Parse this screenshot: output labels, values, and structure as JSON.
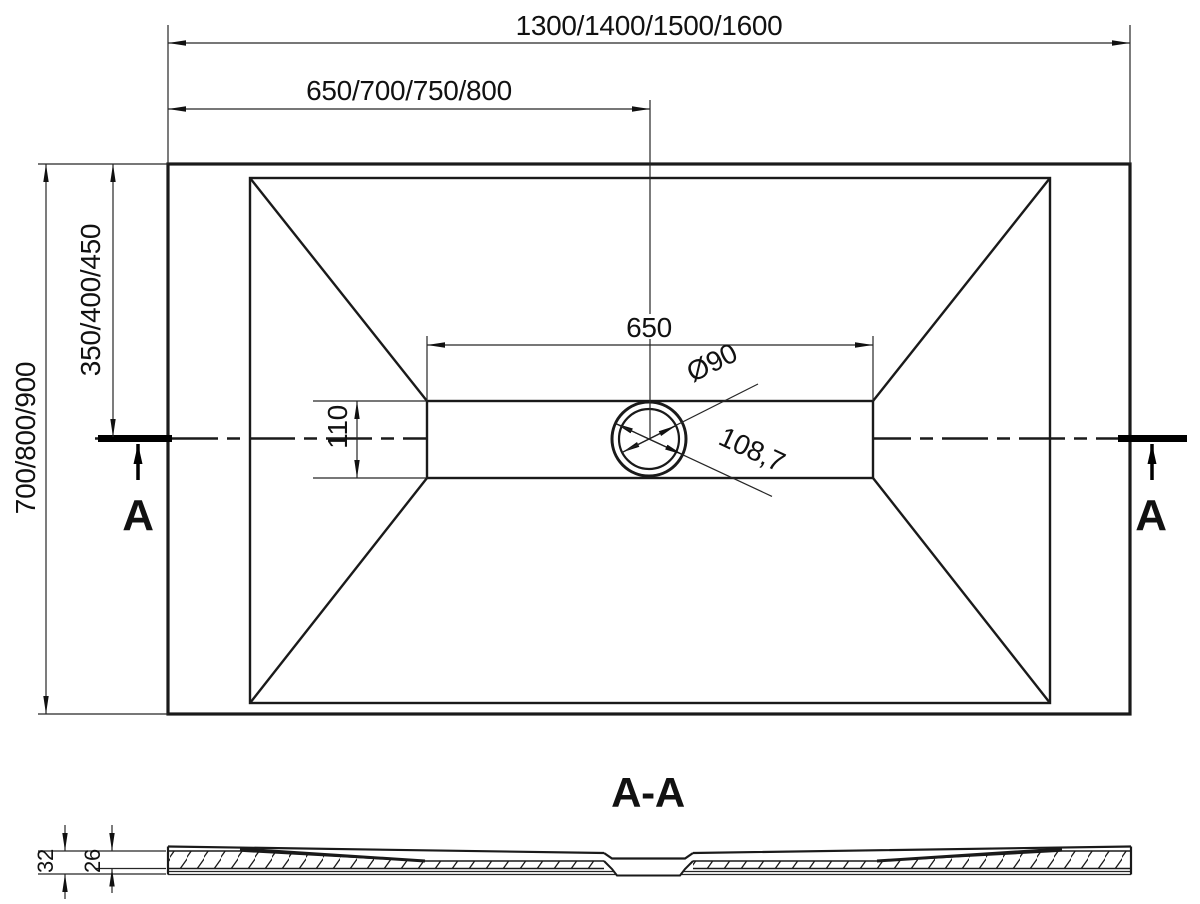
{
  "drawing": {
    "background": "#ffffff",
    "line_color": "#1a1a1a",
    "top_view": {
      "dim_width_total": "1300/1400/1500/1600",
      "dim_width_to_drain": "650/700/750/800",
      "dim_depth_total": "700/800/900",
      "dim_depth_to_drain": "350/400/450",
      "dim_channel_length": "650",
      "dim_channel_width": "110",
      "dim_drain_diameter": "Ø90",
      "dim_drain_outer_diameter": "108,7",
      "section_marker_left": "A",
      "section_marker_right": "A"
    },
    "section_view": {
      "title": "A-A",
      "dim_edge_height": "32",
      "dim_base_height": "26"
    }
  }
}
